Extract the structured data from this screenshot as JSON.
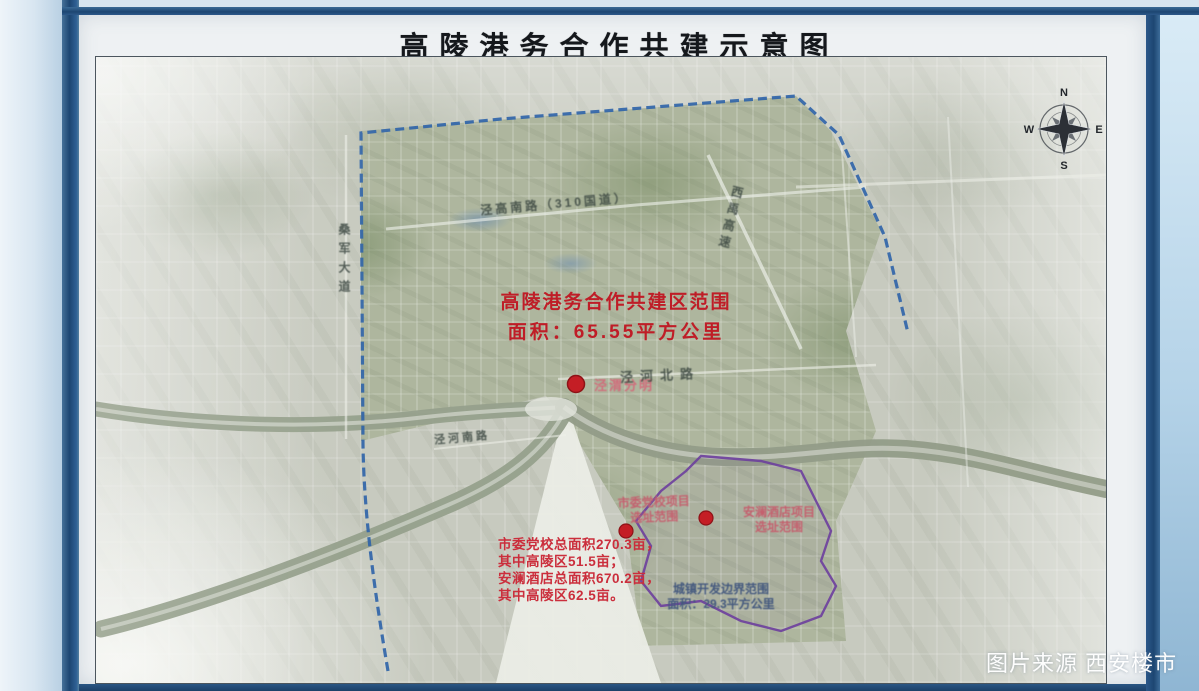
{
  "board": {
    "title": "高陵港务合作共建示意图"
  },
  "compass": {
    "n": "N",
    "e": "E",
    "s": "S",
    "w": "W"
  },
  "map": {
    "zone_callout": {
      "line1": "高陵港务合作共建区范围",
      "line2": "面积：65.55平方公里"
    },
    "poi_jingwei": {
      "label": "泾渭分明"
    },
    "poi_dangxiao": {
      "line1": "市委党校项目",
      "line2": "选址范围"
    },
    "poi_anlan": {
      "line1": "安澜酒店项目",
      "line2": "选址范围"
    },
    "boundary_callout": {
      "line1": "城镇开发边界范围",
      "line2": "面积：29.3平方公里"
    },
    "notes": {
      "line1": "市委党校总面积270.3亩，",
      "line2": "其中高陵区51.5亩；",
      "line3": "安澜酒店总面积670.2亩，",
      "line4": "其中高陵区62.5亩。"
    },
    "roads": {
      "jinggao": "泾高南路（310国道）",
      "jinghe_north": "泾河北路",
      "jinghe_south": "泾河南路",
      "sangjun": "桑军大道",
      "xiyu": "西禹高速"
    }
  },
  "photo": {
    "watermark": "图片来源 西安楼市"
  },
  "colors": {
    "frame_blue": "#1d4672",
    "boundary_blue": "#2e63a8",
    "boundary_purple": "#6d3f9e",
    "callout_red": "#bf1d27"
  }
}
